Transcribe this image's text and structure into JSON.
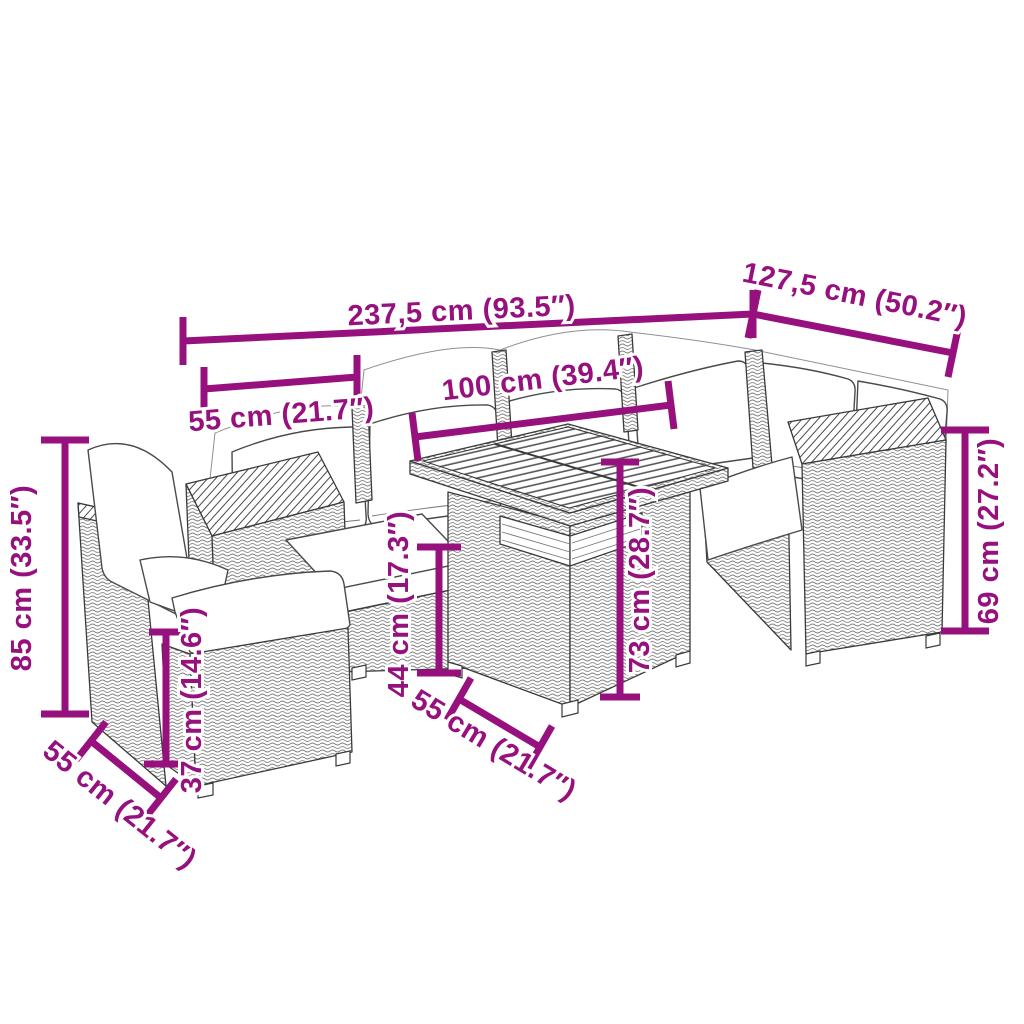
{
  "figure": {
    "kind": "product-dimension-diagram",
    "subject": "garden-lounge-set-with-table",
    "accent_color": "#96117e",
    "line_color": "#3a3a3a",
    "background": "#ffffff"
  },
  "dimensions": [
    {
      "name": "overall-width",
      "label": "237,5 cm (93.5″)"
    },
    {
      "name": "overall-depth",
      "label": "127,5 cm (50.2″)"
    },
    {
      "name": "sofa-section-width",
      "label": "55 cm (21.7″)"
    },
    {
      "name": "table-length",
      "label": "100 cm (39.4″)"
    },
    {
      "name": "chair-height",
      "label": "85 cm (33.5″)"
    },
    {
      "name": "sofa-height",
      "label": "69 cm (27.2″)"
    },
    {
      "name": "seat-height",
      "label": "44 cm (17.3″)"
    },
    {
      "name": "table-height",
      "label": "73 cm (28.7″)"
    },
    {
      "name": "stool-height",
      "label": "37 cm (14.6″)"
    },
    {
      "name": "stool-depth",
      "label": "55 cm (21.7″)"
    },
    {
      "name": "table-depth",
      "label": "55 cm (21.7″)"
    }
  ]
}
